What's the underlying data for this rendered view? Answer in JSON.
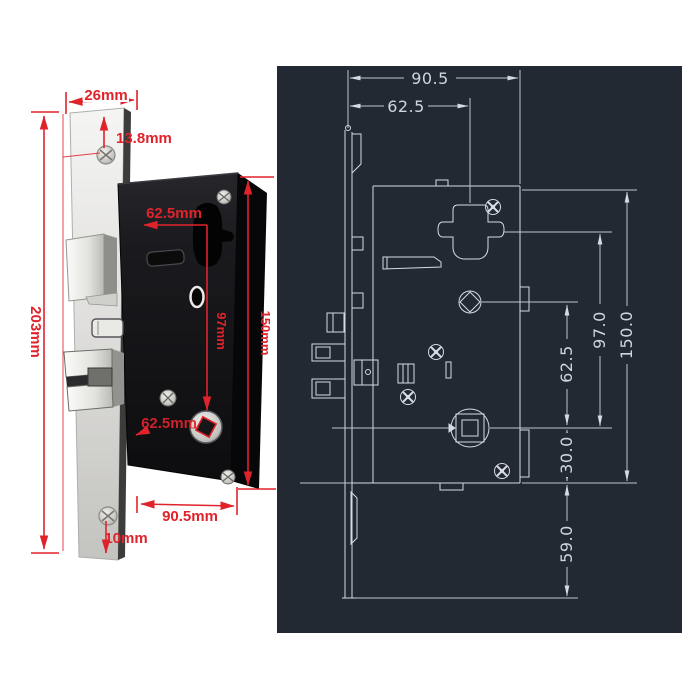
{
  "colors": {
    "accent_red": "#e0232b",
    "panel_background": "#232932",
    "cad_line": "#d5dbe2",
    "cad_text": "#cfd6dd"
  },
  "photo": {
    "labels": {
      "plate_width": "26mm",
      "screw_top_offset": "13.8mm",
      "plate_height": "203mm",
      "cylinder_offset": "62.5mm",
      "cylinder_to_spindle": "97mm",
      "body_height": "150mm",
      "spindle_offset": "62.5mm",
      "body_width": "90.5mm",
      "screw_bottom_offset": "10mm"
    }
  },
  "diagram": {
    "labels": {
      "overall_width": "90.5",
      "cylinder_offset": "62.5",
      "right_center_distance": "62.5",
      "right_backset": "97.0",
      "right_body_height": "150.0",
      "right_spindle_to_bottom": "30.0",
      "right_bottom_extension": "59.0"
    }
  }
}
